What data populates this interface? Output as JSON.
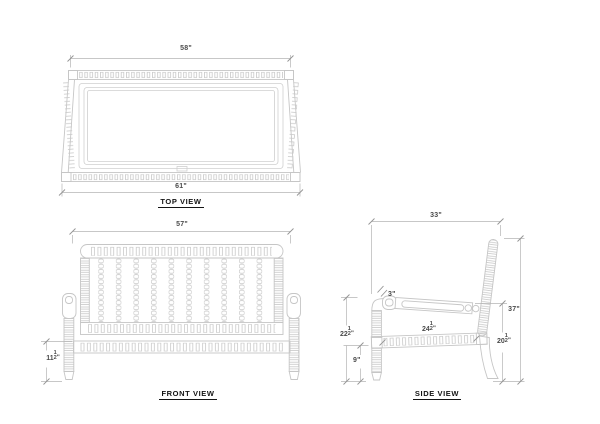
{
  "views": {
    "top": {
      "label": "TOP VIEW",
      "dim_back_width": "58\"",
      "dim_front_width": "61\""
    },
    "front": {
      "label": "FRONT VIEW",
      "dim_width": "57\"",
      "dim_leg_height": {
        "whole": "11",
        "num": "1",
        "den": "2",
        "unit": "\""
      }
    },
    "side": {
      "label": "SIDE VIEW",
      "dim_depth": "33\"",
      "dim_total_height": "37\"",
      "dim_arm_front": "3\"",
      "dim_arm_height": {
        "whole": "22",
        "num": "1",
        "den": "2",
        "unit": "\""
      },
      "dim_seat_clearance": "9\"",
      "dim_seat_depth": {
        "whole": "24",
        "num": "1",
        "den": "2",
        "unit": "\""
      },
      "dim_back_leg_height": {
        "whole": "20",
        "num": "1",
        "den": "2",
        "unit": "\""
      }
    }
  }
}
